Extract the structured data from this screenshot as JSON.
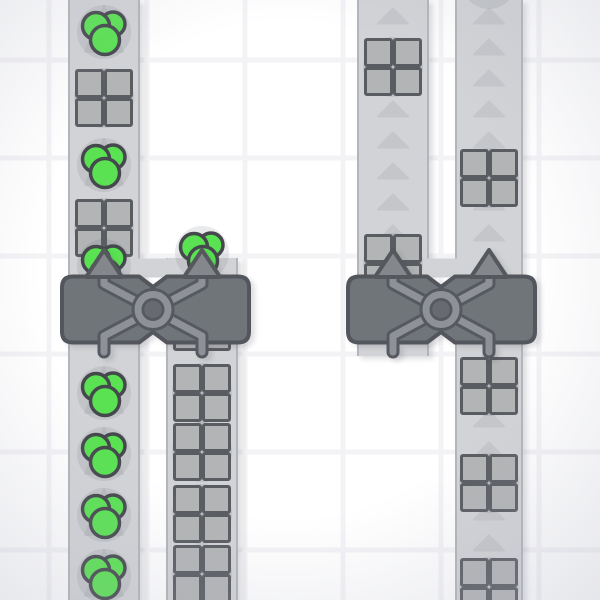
{
  "scene": {
    "canvas": {
      "width": 600,
      "height": 600
    },
    "background": {
      "tile_color": "#ffffff",
      "grid_line_color": "#f3f3f6",
      "grid_offset_x": 49,
      "grid_offset_y": 60,
      "grid_size": 98,
      "grid_line_width": 5,
      "vignette_color": "rgba(172,175,190,0.30)"
    },
    "colors": {
      "belt": "#d2d3d6",
      "belt_edge": "rgba(110,114,130,0.30)",
      "chevron": "#c5c6ca",
      "chevron_large": "#c6c7cb",
      "item_shadow": "rgba(100,104,120,0.14)",
      "square_fill": "#b3b4b6",
      "square_stroke": "#595c61",
      "green_fill": "#5ae253",
      "green_stroke": "#45484d",
      "machine_fill": "#70747a",
      "machine_stroke": "#53565c",
      "pipe_light": "#8e9298",
      "pipe_casing": "#575a60",
      "ring_hole": "#686b71",
      "arrow_fill": "#84888d",
      "arrow_stroke": "#55585d",
      "drop_shadow": "#3a3e50"
    },
    "metrics": {
      "machine_top": 276.5,
      "machine_bottom": 342.5,
      "machine_corner_radius": 11,
      "notch_half_width": 14,
      "notch_depth": 10.5,
      "slab_y": 258.5,
      "slab_height": 19,
      "arrow_apex_y": 250,
      "arrow_base_y": 277,
      "arrow_half_width": 18,
      "leg_bottom_y": 352,
      "ring_radius": 15,
      "ring_hole_radius": 8.5,
      "pipe_width": 7,
      "pipe_casing_width": 13,
      "square_item_size": 55,
      "small_chevron": {
        "width": 30,
        "height": 15,
        "start_y": 16,
        "spacing": 31
      },
      "large_chevron": {
        "half_width": 19,
        "above": 26,
        "below": 20
      }
    },
    "belts": [
      {
        "name": "belt-1",
        "x": 68,
        "width": 72,
        "top": 0,
        "bottom": 600,
        "arrow_style": "large",
        "items": [
          {
            "type": "circles",
            "y": 32,
            "arrow": true
          },
          {
            "type": "squares",
            "y": 98,
            "arrow": true
          },
          {
            "type": "circles",
            "y": 165,
            "arrow": true
          },
          {
            "type": "squares",
            "y": 228,
            "arrow": true
          },
          {
            "type": "circles",
            "y": 266,
            "arrow": false
          },
          {
            "type": "circles",
            "y": 393,
            "arrow": true
          },
          {
            "type": "circles",
            "y": 454,
            "arrow": true
          },
          {
            "type": "circles",
            "y": 515,
            "arrow": true
          },
          {
            "type": "circles",
            "y": 576,
            "arrow": true
          }
        ]
      },
      {
        "name": "belt-2",
        "x": 166,
        "width": 72,
        "top": 258,
        "bottom": 600,
        "arrow_style": "large",
        "items": [
          {
            "type": "circles",
            "y": 253,
            "arrow": false
          },
          {
            "type": "squares",
            "y": 322,
            "arrow": false
          },
          {
            "type": "squares",
            "y": 393,
            "arrow": true
          },
          {
            "type": "squares",
            "y": 452,
            "arrow": true
          },
          {
            "type": "squares",
            "y": 514,
            "arrow": true
          },
          {
            "type": "squares",
            "y": 574,
            "arrow": true
          }
        ]
      },
      {
        "name": "belt-3",
        "x": 357,
        "width": 72,
        "top": 0,
        "bottom": 356,
        "arrow_style": "small",
        "arrow_max_y": 272,
        "items": [
          {
            "type": "squares",
            "y": 67
          },
          {
            "type": "squares",
            "y": 263
          }
        ]
      },
      {
        "name": "belt-4",
        "x": 455,
        "width": 68,
        "top": 0,
        "bottom": 600,
        "arrow_style": "small",
        "arrow_max_y": 600,
        "items": [
          {
            "type": "shadow",
            "y": -18
          },
          {
            "type": "squares",
            "y": 178
          },
          {
            "type": "squares",
            "y": 386
          },
          {
            "type": "squares",
            "y": 483
          },
          {
            "type": "squares",
            "y": 587
          }
        ]
      }
    ],
    "machines": [
      {
        "name": "balancer-1",
        "x": 62,
        "width": 187,
        "ports": [
          104,
          202
        ]
      },
      {
        "name": "balancer-2",
        "x": 348,
        "width": 187,
        "ports": [
          393,
          489
        ]
      }
    ]
  }
}
